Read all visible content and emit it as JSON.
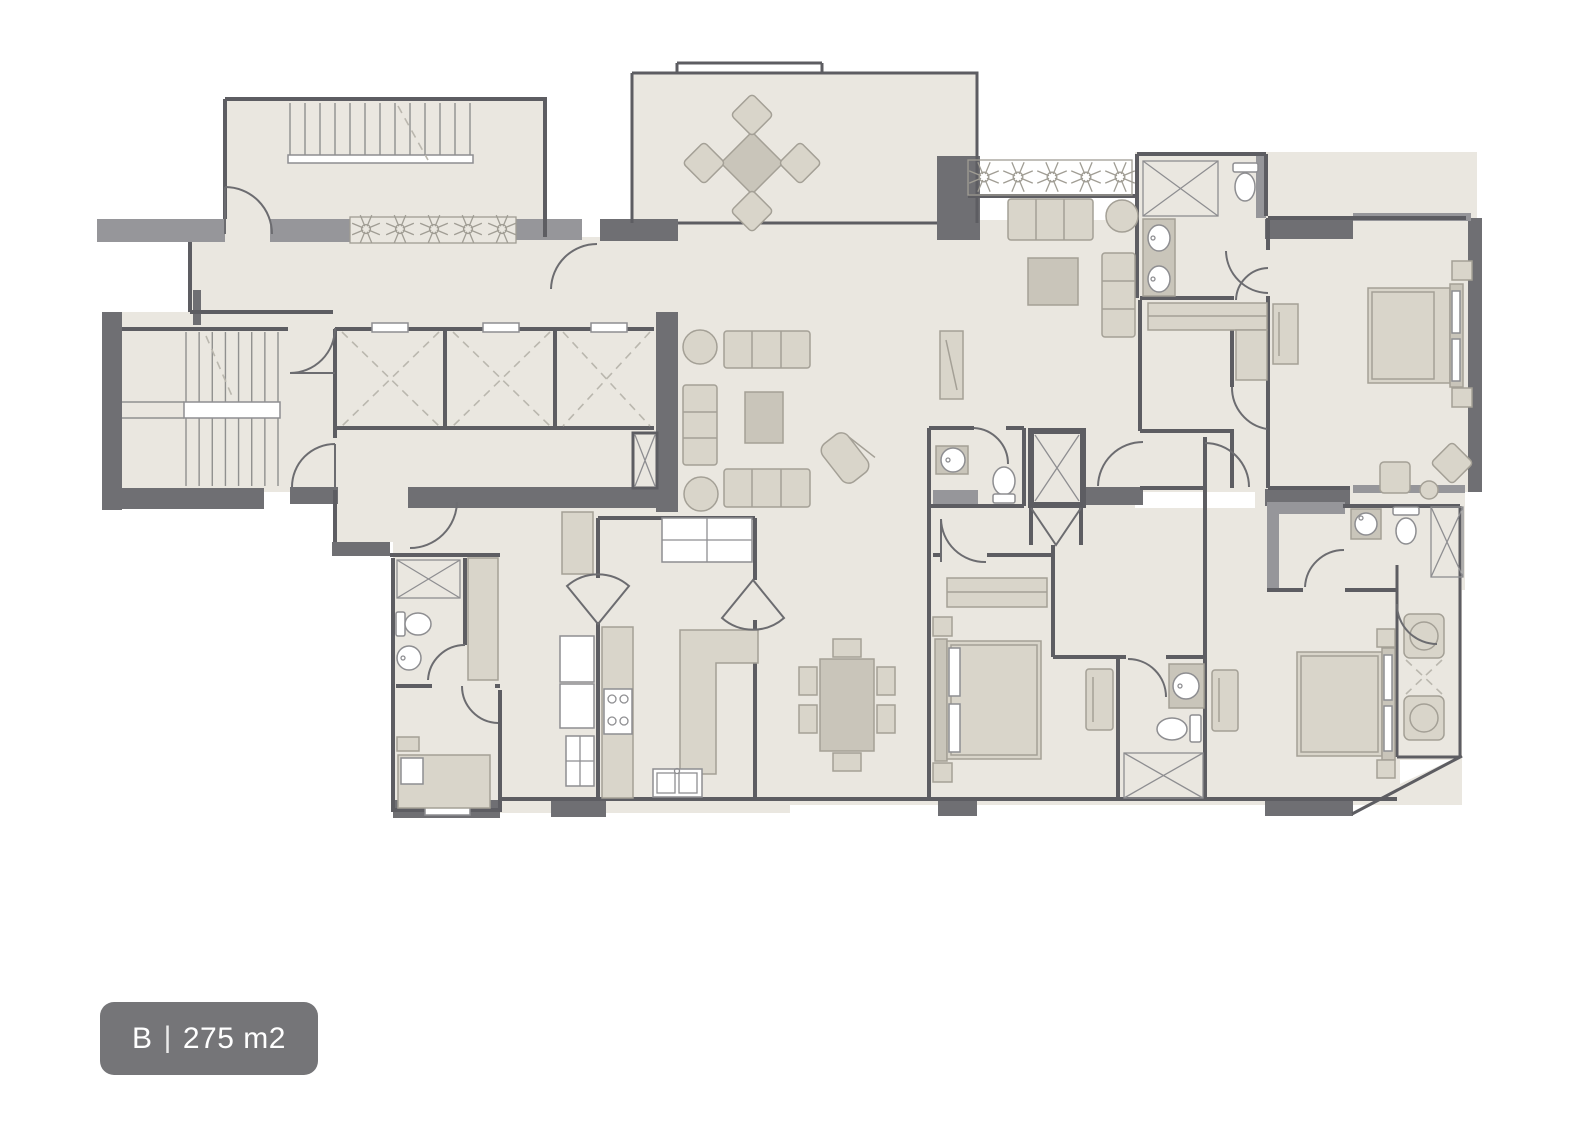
{
  "page": {
    "background_color": "#ffffff"
  },
  "unit_badge": {
    "unit_name": "B",
    "separator": "|",
    "area_label": "275 m2",
    "background_color": "#757578",
    "text_color": "#ffffff"
  },
  "floor_plan": {
    "type": "residential-apartment-floor-plan",
    "colors": {
      "page-bg": "#ffffff",
      "floor": "#eae7e0",
      "wall-dark": "#6f6f73",
      "wall-mid": "#96969a",
      "wall-line": "#5d5d62",
      "fixture-line": "#8e8e91",
      "fixture-fill": "#ffffff",
      "furniture-fill": "#d9d5ca",
      "furniture-dark": "#c9c5ba",
      "furniture-line": "#a4a096",
      "door-line": "#6c6c70",
      "dash-line": "#bab7ae",
      "plant-line": "#a09d94",
      "stair-line": "#90908f",
      "badge-bg": "#757578",
      "badge-fg": "#ffffff"
    }
  }
}
